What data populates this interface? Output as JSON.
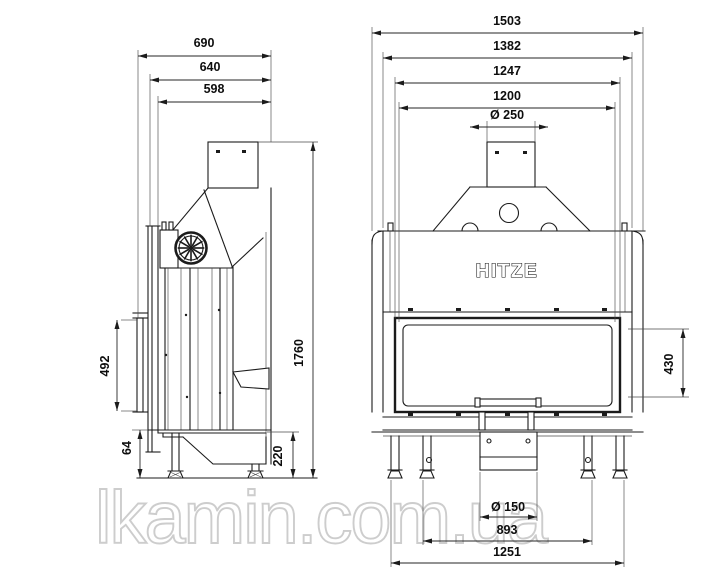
{
  "watermark": "lkamin.com.ua",
  "drawing": {
    "brand_logo": "HITZE",
    "side_view": {
      "depth_total": "690",
      "depth_mid": "640",
      "depth_inner": "598",
      "height_total": "1760",
      "glass_height": "492",
      "foot_clearance": "64",
      "base_height": "220"
    },
    "front_view": {
      "width_total": "1503",
      "width_outer": "1382",
      "width_frame": "1247",
      "width_glass": "1200",
      "flue_diameter": "Ø 250",
      "glass_height": "430",
      "air_inlet_diameter": "Ø 150",
      "legs_span_inner": "893",
      "legs_span_outer": "1251"
    }
  }
}
